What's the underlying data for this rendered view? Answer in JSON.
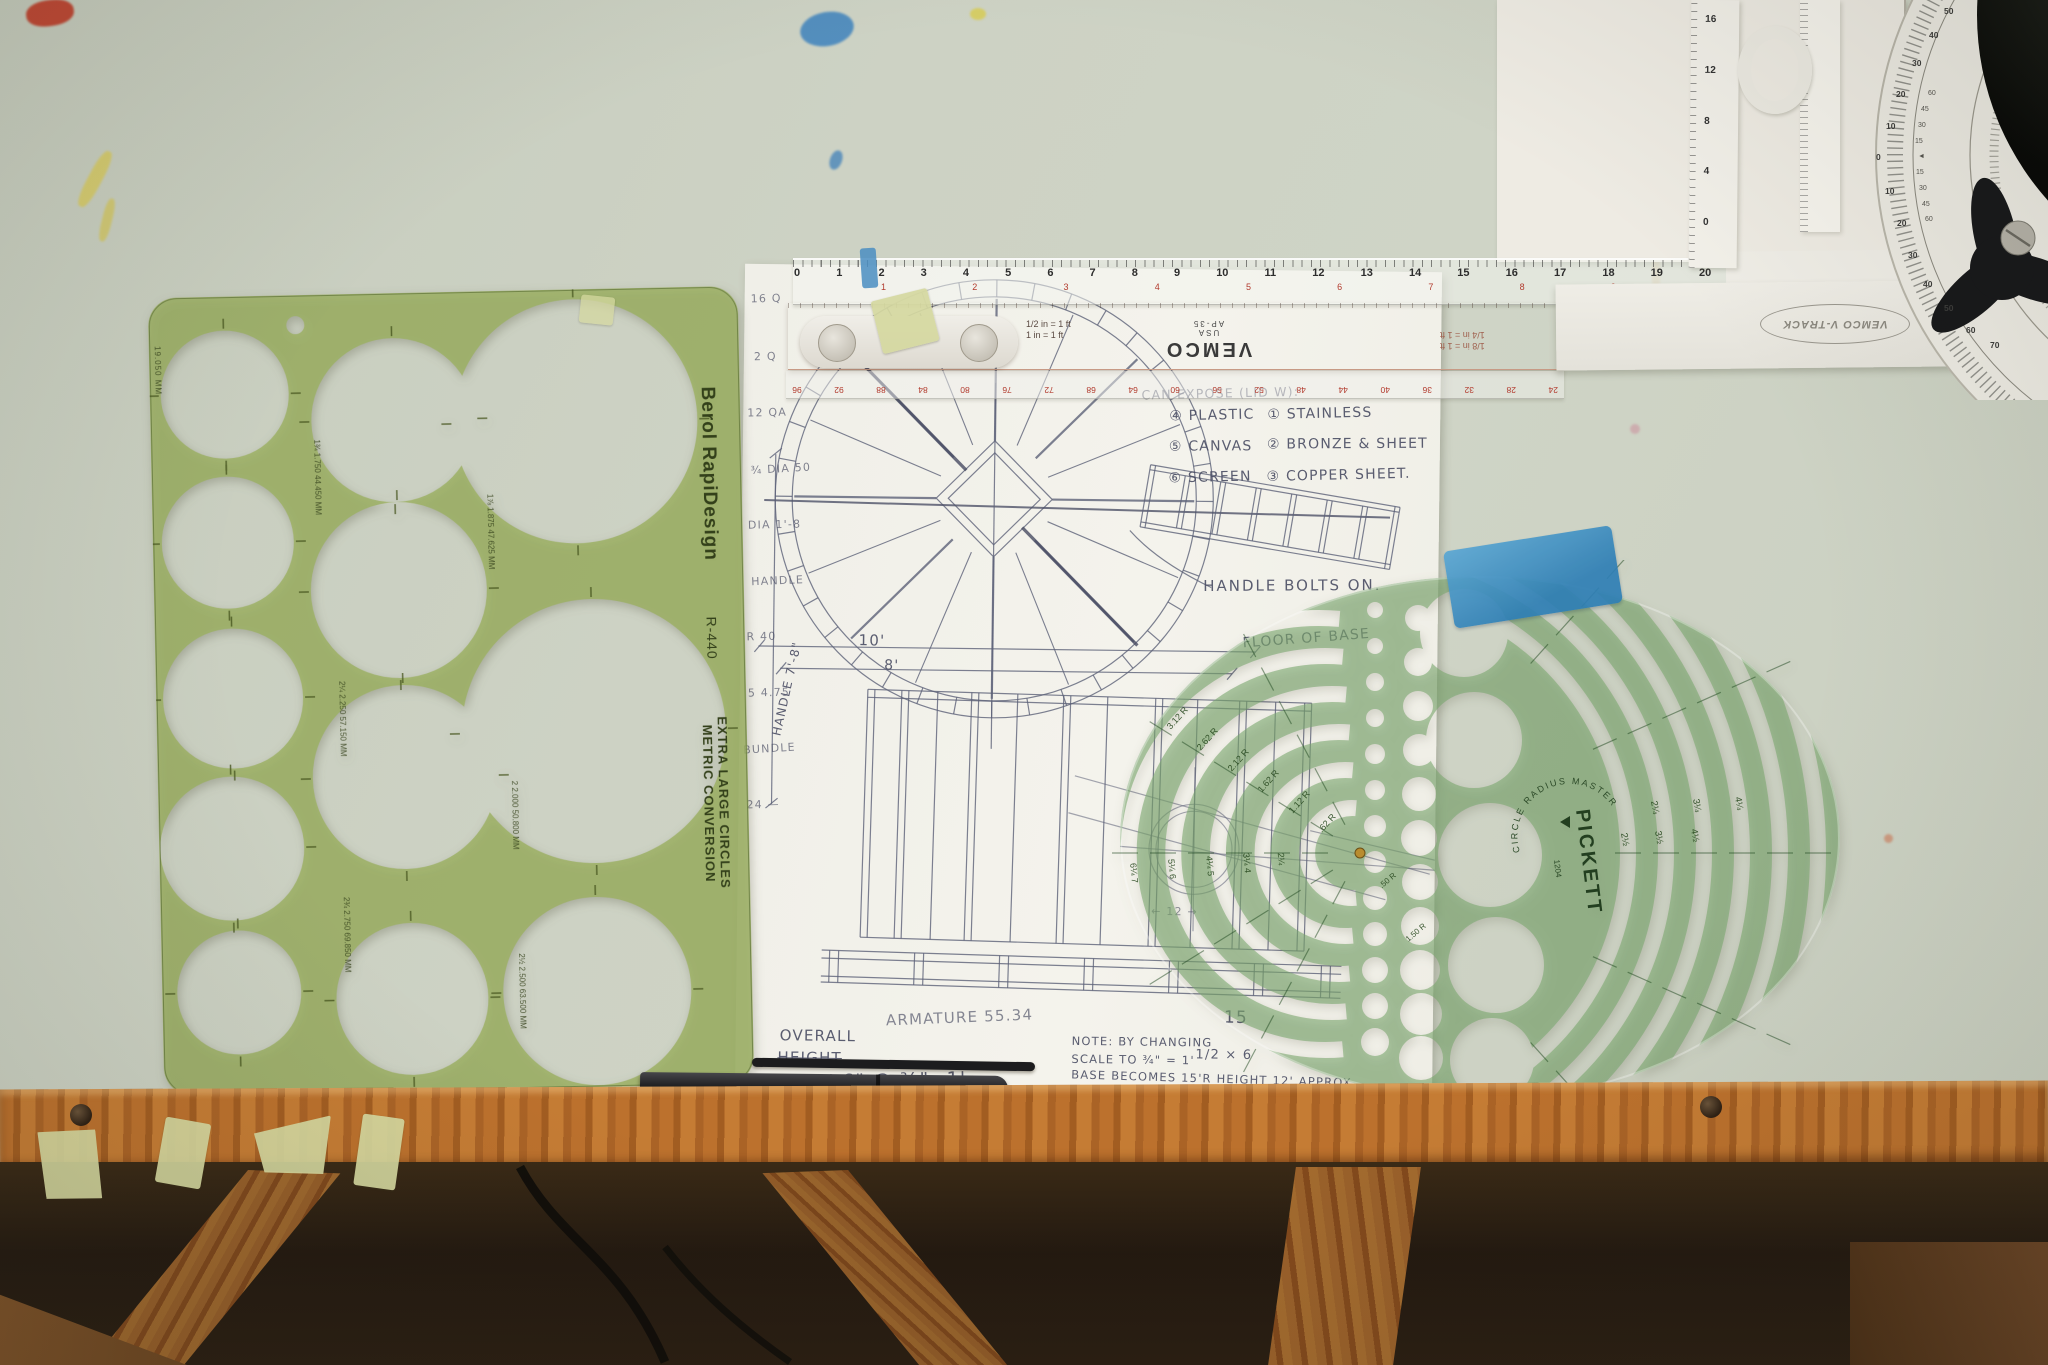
{
  "scene": {
    "title": "Drafting table with circle templates, scales and hand-drawn sketch"
  },
  "colors": {
    "table": "#cdd2c4",
    "berol_green": "#9cb063",
    "pickett_green": "#7da96f",
    "scale_pink": "#eac3af",
    "wood": "#b06a2a",
    "tape_blue": "#3d8fc4"
  },
  "berol": {
    "brand": "Berol RapiDesign",
    "model": "R-440",
    "line1": "EXTRA LARGE CIRCLES",
    "line2": "METRIC CONVERSION",
    "corner": "19.050 MM",
    "size_labels": [
      "1¾ 1.750 44.450 MM",
      "1⅞ 1.875 47.625 MM",
      "2 2.000 50.800 MM",
      "2¼ 2.250 57.150 MM",
      "2½ 2.500 63.500 MM",
      "2¾ 2.750 69.850 MM"
    ]
  },
  "vemco": {
    "brand": "VEMCO",
    "country": "USA",
    "model": "AP-35",
    "scale_l1": "1/2 in = 1 ft",
    "scale_l2": "1 in = 1 ft",
    "scale_r1": "1/8 in = 1 ft",
    "scale_r2": "1/4 in = 1 ft"
  },
  "ruler": {
    "black": [
      "0",
      "1",
      "2",
      "3",
      "4",
      "5",
      "6",
      "7",
      "8",
      "9",
      "10",
      "11",
      "12",
      "13",
      "14",
      "15",
      "16",
      "17",
      "18",
      "19",
      "20",
      "21",
      "22",
      "23",
      "24"
    ],
    "red": [
      "1",
      "2",
      "3",
      "4",
      "5",
      "6",
      "7",
      "8",
      "9",
      "10",
      "11",
      "12"
    ],
    "bottom": [
      "24",
      "28",
      "32",
      "36",
      "40",
      "44",
      "48",
      "52",
      "56",
      "60",
      "64",
      "68",
      "72",
      "76",
      "80",
      "84",
      "88",
      "92",
      "96"
    ]
  },
  "arm": {
    "logo": "VEMCO V-TRACK",
    "vert": [
      "16",
      "12",
      "8",
      "4",
      "0"
    ]
  },
  "dial": {
    "outer": [
      "50",
      "40",
      "30",
      "20",
      "10",
      "0",
      "10",
      "20",
      "30",
      "40",
      "50",
      "60",
      "70"
    ],
    "inner": [
      "60",
      "45",
      "30",
      "15",
      "◄",
      "15",
      "30",
      "45",
      "60"
    ]
  },
  "sketch": {
    "header": "CAN EXPOSE (LID W):",
    "mat_left": [
      "④ PLASTIC",
      "⑤ CANVAS",
      "⑥ SCREEN"
    ],
    "mat_right": [
      "① STAINLESS",
      "② BRONZE & SHEET",
      "③ COPPER SHEET."
    ],
    "handle_note": "HANDLE BOLTS ON.",
    "floor_note": "FLOOR OF BASE",
    "dim_a": "10'",
    "dim_b": "8'",
    "handle_dim": "HANDLE 7'-8\"",
    "overall_l1": "OVERALL",
    "overall_l2": "HEIGHT",
    "overall_l3": "8'·6\" @ ¾\"=1'",
    "armature": "ARMATURE  55.34",
    "note_l1": "NOTE: BY CHANGING",
    "note_l2": "SCALE TO ¾\" = 1'",
    "note_l3": "BASE BECOMES 15'R HEIGHT 12' APPROX",
    "fig_a": "15",
    "fig_b": "1/2 × 6",
    "fig_c": "9 2",
    "fig_d": "← 12 →",
    "margin": [
      "16 Q",
      "2 Q",
      "12 QA",
      "¾ DIA 50",
      "DIA 1'-8",
      "HANDLE",
      "R 40",
      "5 4.75",
      "BUNDLE",
      "24 —"
    ]
  },
  "pickett": {
    "brand": "PICKETT",
    "product": "CIRCLE RADIUS MASTER",
    "model": "1204",
    "radius_labels": [
      ".62 R",
      "1.12 R",
      "1.62 R",
      "2.12 R",
      "2.62 R",
      "3.12 R"
    ],
    "left_labels": [
      "2¼",
      "3¼ 4",
      "4¼ 5",
      "5¼ 6",
      "6¼ 7"
    ],
    "right_labels_top": [
      "2¼",
      "3¼",
      "4¼"
    ],
    "right_labels_bot": [
      "2½",
      "3½",
      "4½"
    ],
    "extra_labels": [
      "1.50 R",
      ".50 R"
    ]
  }
}
